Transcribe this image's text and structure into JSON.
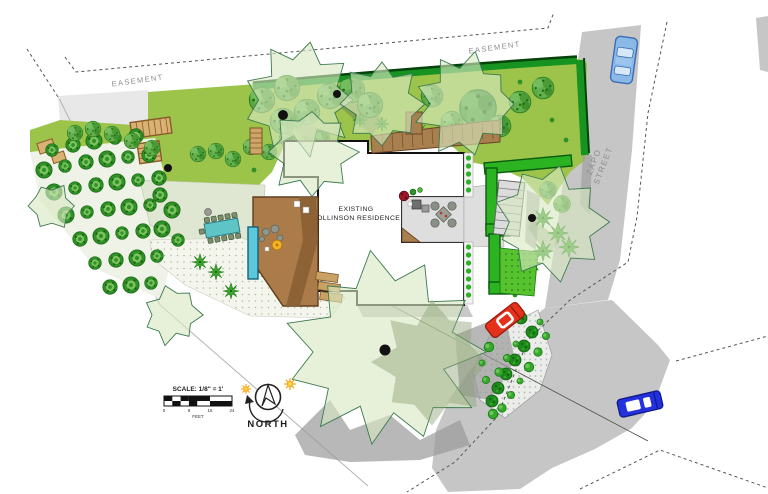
{
  "labels": {
    "easement_left": "EASEMENT",
    "easement_right": "EASEMENT",
    "street_line1": "ZAPO",
    "street_line2": "STREET",
    "residence_line1": "EXISTING",
    "residence_line2": "COLLINSON RESIDENCE",
    "north": "NORTH",
    "scale_title": "SCALE: 1/8\" = 1'",
    "scale_unit": "FEET",
    "scale_tick_0": "0",
    "scale_tick_8": "8",
    "scale_tick_16": "16",
    "scale_tick_24": "24"
  },
  "colors": {
    "lawn": "#9cc44b",
    "hedge": "#169321",
    "hedge_dark": "#05430a",
    "hedge_bright": "#2cb322",
    "canopy": "#d9e8c2",
    "canopy_stroke": "#3c7a50",
    "canopy_shadow": "#8fa276",
    "street": "#c6c6c6",
    "island": "#ecece8",
    "building": "#ffffff",
    "outline": "#111111",
    "deck": "#ab7c4a",
    "deck_dark": "#8a5f33",
    "wood_light": "#cfa667",
    "pool": "#5bc8dc",
    "table_teal": "#5fc4c6",
    "patio": "#dedede",
    "bed_sage": "#dfe7d2",
    "bed_light": "#f4f6ee",
    "shrub": "#2f9127",
    "tree": "#5aa844",
    "frond": "#3fa52e",
    "red_car": "#e43119",
    "blue_car": "#2230dd",
    "light_blue_car": "#8ab9e8",
    "sun": "#f5a81c",
    "shadow": "#9a9a9a",
    "text_gray": "#8d8d8d",
    "text_dark": "#1c1c1c"
  }
}
